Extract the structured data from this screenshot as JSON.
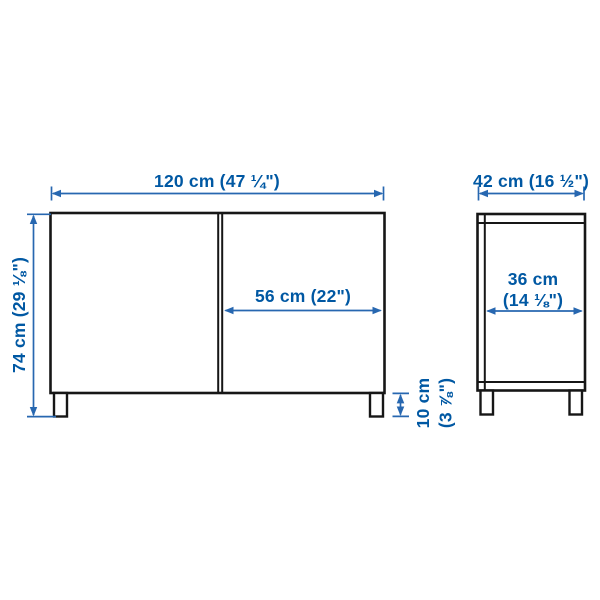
{
  "diagram": {
    "type": "furniture-dimension-diagram",
    "accent_color": "#0058A3",
    "outline_color": "#161616",
    "background_color": "#ffffff",
    "front_view": {
      "overall_width_label": "120 cm (47 ¼\")",
      "overall_height_label": "74 cm (29 ⅛\")",
      "door_width_label": "56 cm (22\")",
      "leg_height_label_line1": "10 cm",
      "leg_height_label_line2": "(3 ⅞\")"
    },
    "side_view": {
      "overall_depth_label": "42 cm (16 ½\")",
      "interior_depth_label_line1": "36 cm",
      "interior_depth_label_line2": "(14 ⅛\")"
    }
  }
}
